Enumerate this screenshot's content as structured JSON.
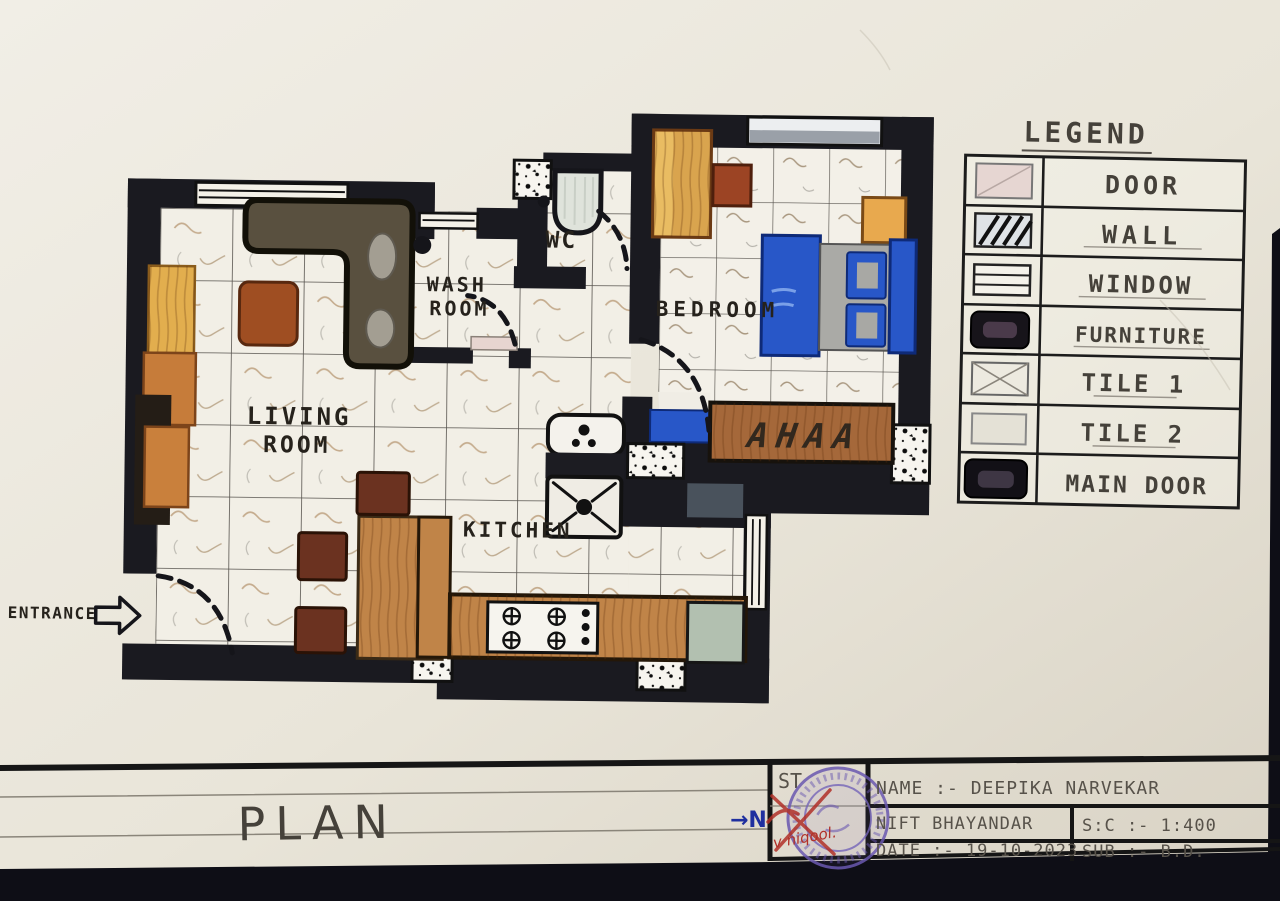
{
  "plan": {
    "labels": {
      "living_line1": "LIVING",
      "living_line2": "ROOM",
      "wash_line1": "WASH",
      "wash_line2": "ROOM",
      "wc": "WC",
      "bedroom": "BEDROOM",
      "kitchen": "KITCHEN",
      "entrance": "ENTRANCE"
    },
    "console_marks": "AHAA"
  },
  "legend": {
    "title": "LEGEND",
    "items": [
      {
        "label": "DOOR",
        "symbol": "door-swatch"
      },
      {
        "label": "WALL",
        "symbol": "wall-hatch-swatch"
      },
      {
        "label": "WINDOW",
        "symbol": "window-swatch"
      },
      {
        "label": "FURNITURE",
        "symbol": "furniture-swatch"
      },
      {
        "label": "TILE 1",
        "symbol": "tile1-swatch"
      },
      {
        "label": "TILE 2",
        "symbol": "tile2-swatch"
      },
      {
        "label": "MAIN DOOR",
        "symbol": "main-door-swatch"
      }
    ]
  },
  "titleblock": {
    "drawing_title": "PLAN",
    "north_label": "→N",
    "stamp_label": "ST",
    "stamp_note": "v niqool.",
    "name": "NAME :- DEEPIKA NARVEKAR",
    "institute": "NIFT BHAYANDAR",
    "scale": "S:C :- 1:400",
    "date": "DATE :- 19-10-2023",
    "subject": "SUB :- B.D."
  },
  "colors": {
    "wall": "#1a1a20",
    "wood_tan": "#c08448",
    "sofa_brown": "#59503f",
    "bed_blue": "#2857c8",
    "appliance_green": "#b2c0b0",
    "stamp_purple": "#6a58b0",
    "north_blue": "#1f2f9f",
    "paper": "#ece8dd"
  }
}
